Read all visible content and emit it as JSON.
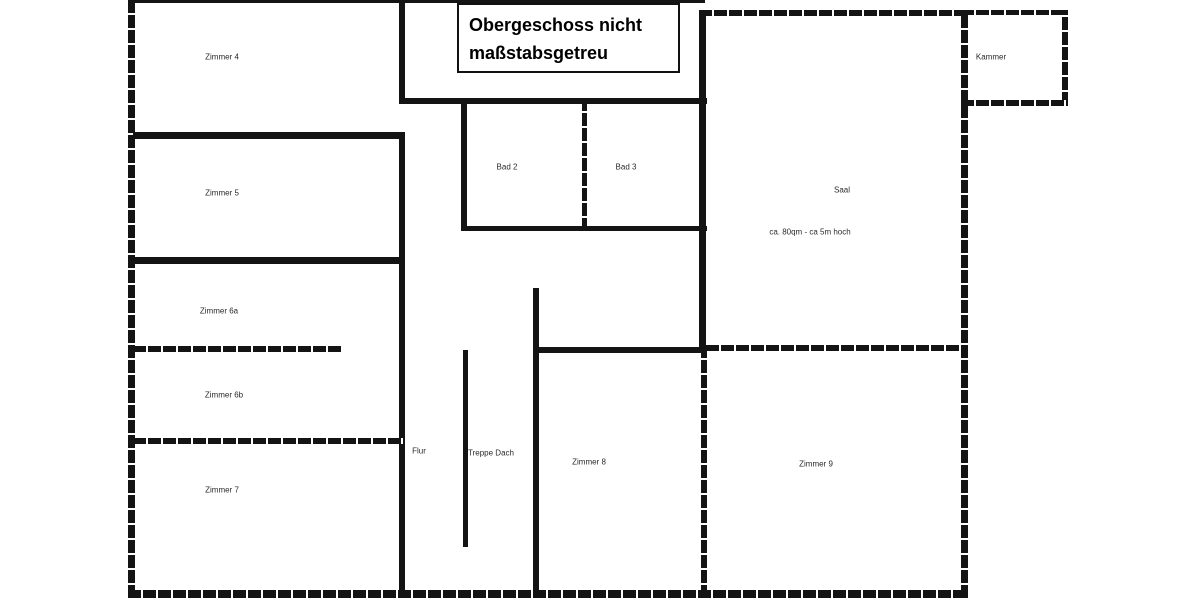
{
  "title_box": {
    "line1": "Obergeschoss nicht",
    "line2": "maßstabsgetreu"
  },
  "colors": {
    "wall": "#141414",
    "background": "#ffffff",
    "label_text": "#2a2a2a"
  },
  "labels": [
    {
      "name": "room-label-zimmer-4",
      "text": "Zimmer 4",
      "x": 222,
      "y": 57
    },
    {
      "name": "room-label-zimmer-5",
      "text": "Zimmer 5",
      "x": 222,
      "y": 193
    },
    {
      "name": "room-label-zimmer-6a",
      "text": "Zimmer 6a",
      "x": 219,
      "y": 311
    },
    {
      "name": "room-label-zimmer-6b",
      "text": "Zimmer 6b",
      "x": 224,
      "y": 395
    },
    {
      "name": "room-label-zimmer-7",
      "text": "Zimmer 7",
      "x": 222,
      "y": 490
    },
    {
      "name": "room-label-bad-2",
      "text": "Bad 2",
      "x": 507,
      "y": 167
    },
    {
      "name": "room-label-bad-3",
      "text": "Bad 3",
      "x": 626,
      "y": 167
    },
    {
      "name": "room-label-saal",
      "text": "Saal",
      "x": 842,
      "y": 190
    },
    {
      "name": "room-note-saal-size",
      "text": "ca. 80qm - ca 5m hoch",
      "x": 810,
      "y": 232
    },
    {
      "name": "room-label-kammer",
      "text": "Kammer",
      "x": 991,
      "y": 57
    },
    {
      "name": "room-label-flur",
      "text": "Flur",
      "x": 419,
      "y": 451
    },
    {
      "name": "room-label-treppe-dach",
      "text": "Treppe Dach",
      "x": 491,
      "y": 453
    },
    {
      "name": "room-label-zimmer-8",
      "text": "Zimmer 8",
      "x": 589,
      "y": 462
    },
    {
      "name": "room-label-zimmer-9",
      "text": "Zimmer 9",
      "x": 816,
      "y": 464
    }
  ],
  "walls": [
    {
      "name": "wall-outer-left",
      "x": 128,
      "y": 0,
      "w": 7,
      "h": 598,
      "style": "hatched"
    },
    {
      "name": "wall-outer-top",
      "x": 128,
      "y": 0,
      "w": 577,
      "h": 3,
      "style": "solid"
    },
    {
      "name": "wall-outer-bottom",
      "x": 128,
      "y": 590,
      "w": 840,
      "h": 8,
      "style": "hatched"
    },
    {
      "name": "wall-zimmer4-right",
      "x": 399,
      "y": 0,
      "w": 6,
      "h": 103,
      "style": "solid"
    },
    {
      "name": "wall-corridor-top",
      "x": 399,
      "y": 98,
      "w": 308,
      "h": 6,
      "style": "solid"
    },
    {
      "name": "wall-leftcol-right",
      "x": 399,
      "y": 132,
      "w": 6,
      "h": 466,
      "style": "solid"
    },
    {
      "name": "wall-zimmer5-top",
      "x": 133,
      "y": 132,
      "w": 272,
      "h": 7,
      "style": "solid"
    },
    {
      "name": "wall-zimmer5-bottom",
      "x": 133,
      "y": 257,
      "w": 272,
      "h": 7,
      "style": "solid"
    },
    {
      "name": "wall-zimmer6a-6b-divider",
      "x": 133,
      "y": 346,
      "w": 208,
      "h": 6,
      "style": "hatched"
    },
    {
      "name": "wall-zimmer6b-7-divider",
      "x": 133,
      "y": 438,
      "w": 272,
      "h": 6,
      "style": "hatched"
    },
    {
      "name": "wall-bad2-left",
      "x": 461,
      "y": 104,
      "w": 6,
      "h": 127,
      "style": "solid"
    },
    {
      "name": "wall-bad2-bad3-divider",
      "x": 582,
      "y": 103,
      "w": 5,
      "h": 128,
      "style": "hatched"
    },
    {
      "name": "wall-bad-bottom",
      "x": 461,
      "y": 226,
      "w": 246,
      "h": 5,
      "style": "solid"
    },
    {
      "name": "wall-treppe",
      "x": 463,
      "y": 350,
      "w": 5,
      "h": 197,
      "style": "solid"
    },
    {
      "name": "wall-mid-vertical",
      "x": 533,
      "y": 288,
      "w": 6,
      "h": 310,
      "style": "solid"
    },
    {
      "name": "wall-zimmer8-top",
      "x": 533,
      "y": 347,
      "w": 174,
      "h": 6,
      "style": "solid"
    },
    {
      "name": "wall-saal-left",
      "x": 699,
      "y": 10,
      "w": 7,
      "h": 342,
      "style": "solid"
    },
    {
      "name": "wall-saal-top",
      "x": 699,
      "y": 10,
      "w": 269,
      "h": 6,
      "style": "hatched"
    },
    {
      "name": "wall-outer-right",
      "x": 961,
      "y": 10,
      "w": 7,
      "h": 588,
      "style": "hatched"
    },
    {
      "name": "wall-zimmer9-top",
      "x": 706,
      "y": 345,
      "w": 255,
      "h": 6,
      "style": "hatched"
    },
    {
      "name": "wall-zimmer8-9-divider",
      "x": 701,
      "y": 352,
      "w": 6,
      "h": 246,
      "style": "hatched"
    },
    {
      "name": "wall-kammer-top",
      "x": 961,
      "y": 10,
      "w": 107,
      "h": 5,
      "style": "hatched"
    },
    {
      "name": "wall-kammer-right",
      "x": 1062,
      "y": 10,
      "w": 6,
      "h": 95,
      "style": "hatched"
    },
    {
      "name": "wall-kammer-bottom",
      "x": 961,
      "y": 100,
      "w": 107,
      "h": 6,
      "style": "hatched"
    }
  ]
}
